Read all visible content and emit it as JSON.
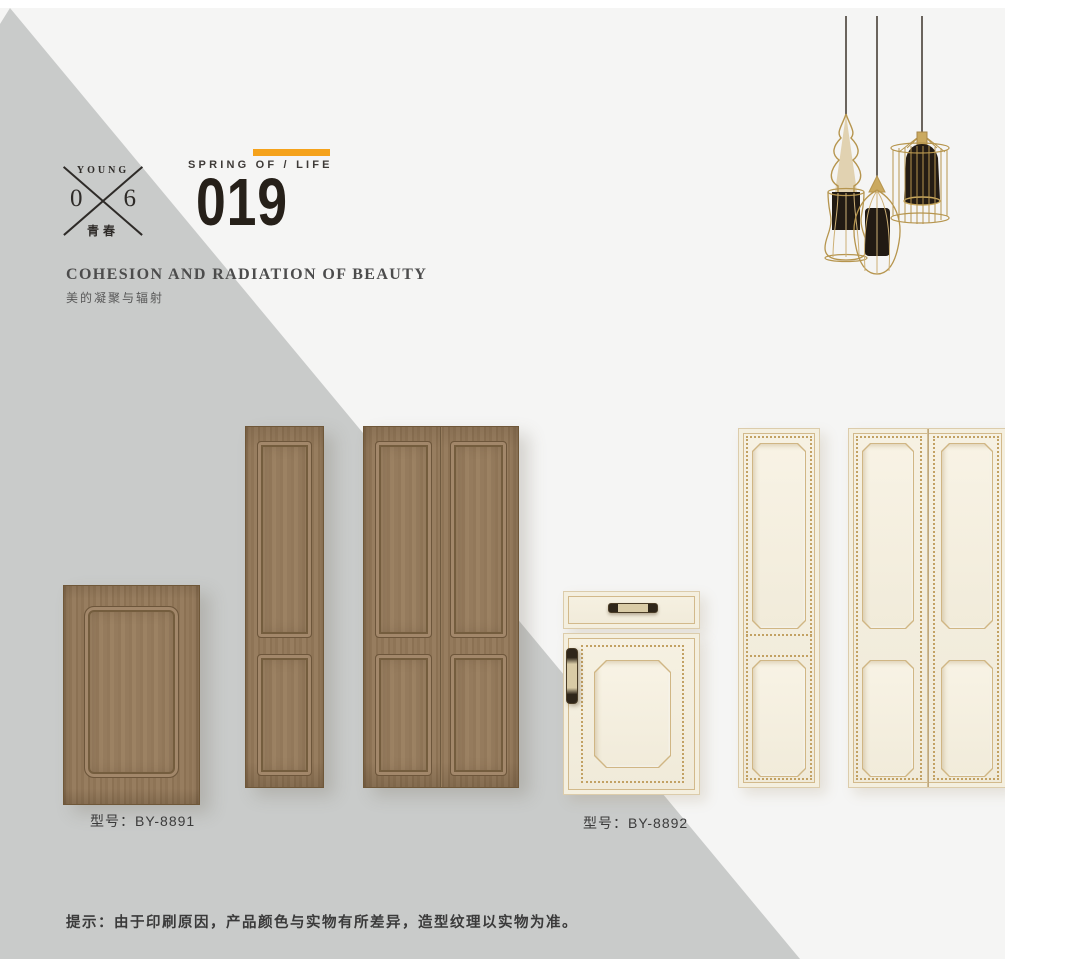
{
  "header": {
    "badge": {
      "word": "YOUNG",
      "digit_left": "0",
      "digit_right": "6",
      "word_cn": "青春"
    },
    "series_label": "SPRING OF / LIFE",
    "page_number": "019",
    "accent_color": "#f5a21b",
    "title_en": "COHESION AND RADIATION OF BEAUTY",
    "title_cn": "美的凝聚与辐射"
  },
  "products": [
    {
      "model_label": "型号：BY-8891",
      "door_color": "#8f7557",
      "pieces": [
        "single small door",
        "tall narrow door",
        "tall double door"
      ]
    },
    {
      "model_label": "型号：BY-8892",
      "door_color": "#f2edde",
      "trim_color": "#c2a163",
      "pieces": [
        "drawer cabinet door",
        "tall narrow door",
        "tall double door"
      ]
    }
  ],
  "footer": {
    "note": "提示：由于印刷原因，产品颜色与实物有所差异，造型纹理以实物为准。"
  },
  "illustration": {
    "name": "pendant-lamps",
    "lamp_count": 3,
    "wire_color": "#b6954e",
    "shade_color": "#211a13"
  },
  "palette": {
    "page_bg": "#ffffff",
    "photo_bg": "#f5f5f4",
    "diagonal_gray": "#c9cbca"
  }
}
